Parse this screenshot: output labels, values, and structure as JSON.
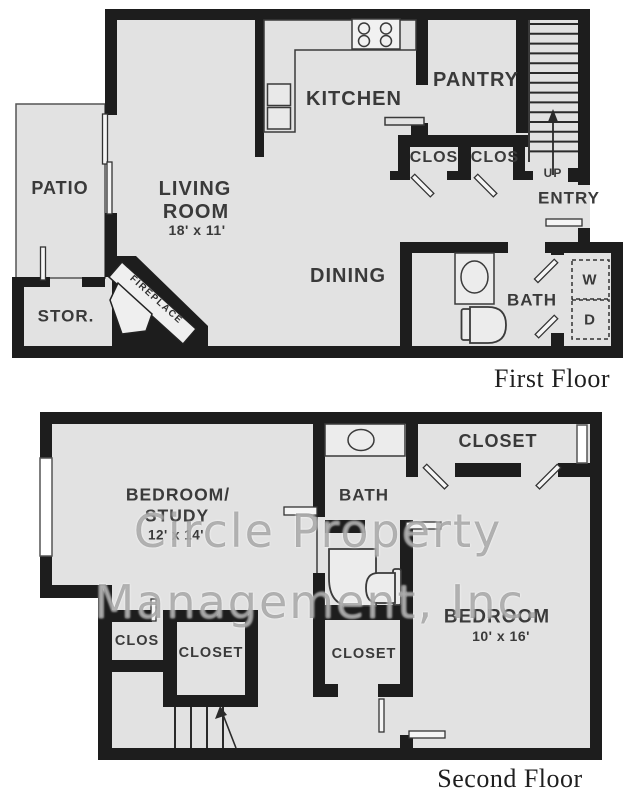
{
  "watermark": {
    "line1": "Circle Property",
    "line2": "Management, Inc."
  },
  "first_floor": {
    "caption": "First Floor",
    "labels": {
      "patio": "PATIO",
      "living_line1": "LIVING",
      "living_line2": "ROOM",
      "living_dims": "18' x 11'",
      "kitchen": "KITCHEN",
      "pantry": "PANTRY",
      "closet_left": "CLOS",
      "closet_right": "CLOS",
      "stairs_up": "UP",
      "entry": "ENTRY",
      "storage": "STOR.",
      "dining": "DINING",
      "bath": "BATH",
      "washer": "W",
      "dryer": "D",
      "fireplace": "FIREPLACE"
    }
  },
  "second_floor": {
    "caption": "Second Floor",
    "labels": {
      "bedroom_study_line1": "BEDROOM/",
      "bedroom_study_line2": "STUDY",
      "bedroom_study_dims": "12' x 14'",
      "bath": "BATH",
      "closet_top": "CLOSET",
      "bedroom": "BEDROOM",
      "bedroom_dims": "10' x 16'",
      "clos": "CLOS",
      "closet_bottom": "CLOSET",
      "closet_middle": "CLOSET"
    }
  },
  "colors": {
    "wall": "#1d1d1d",
    "floor": "#e2e2e2",
    "line": "#3a3a3a",
    "label": "#3a3a3a"
  }
}
